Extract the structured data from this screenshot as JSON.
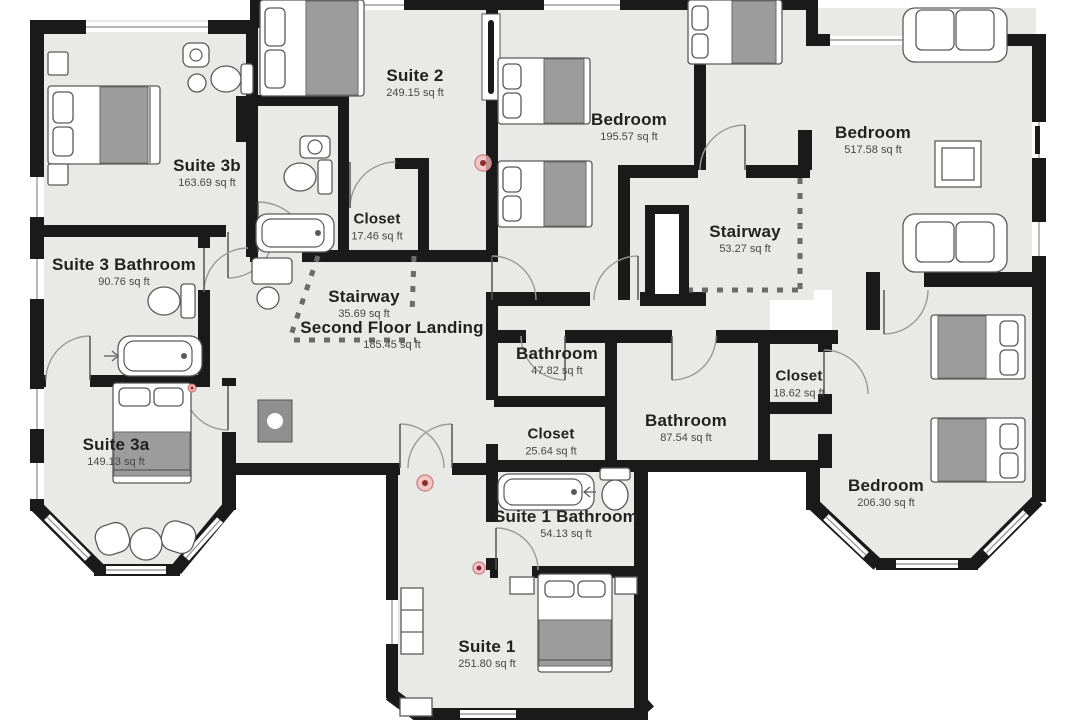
{
  "rooms": [
    {
      "id": "suite-3b",
      "name": "Suite 3b",
      "area": "163.69 sq ft"
    },
    {
      "id": "suite-2",
      "name": "Suite 2",
      "area": "249.15 sq ft"
    },
    {
      "id": "closet-a",
      "name": "Closet",
      "area": "17.46 sq ft"
    },
    {
      "id": "suite-3-bathroom",
      "name": "Suite 3 Bathroom",
      "area": "90.76 sq ft"
    },
    {
      "id": "stairway-a",
      "name": "Stairway",
      "area": "35.69 sq ft"
    },
    {
      "id": "second-floor-landing",
      "name": "Second Floor Landing",
      "area": "185.45 sq ft"
    },
    {
      "id": "bedroom-a",
      "name": "Bedroom",
      "area": "195.57 sq ft"
    },
    {
      "id": "stairway-b",
      "name": "Stairway",
      "area": "53.27 sq ft"
    },
    {
      "id": "bedroom-b",
      "name": "Bedroom",
      "area": "517.58 sq ft"
    },
    {
      "id": "bathroom-a",
      "name": "Bathroom",
      "area": "47.82 sq ft"
    },
    {
      "id": "closet-b",
      "name": "Closet",
      "area": "18.62 sq ft"
    },
    {
      "id": "bathroom-b",
      "name": "Bathroom",
      "area": "87.54 sq ft"
    },
    {
      "id": "closet-c",
      "name": "Closet",
      "area": "25.64 sq ft"
    },
    {
      "id": "suite-3a",
      "name": "Suite 3a",
      "area": "149.13 sq ft"
    },
    {
      "id": "bedroom-c",
      "name": "Bedroom",
      "area": "206.30 sq ft"
    },
    {
      "id": "suite-1-bathroom",
      "name": "Suite 1 Bathroom",
      "area": "54.13 sq ft"
    },
    {
      "id": "suite-1",
      "name": "Suite 1",
      "area": "251.80 sq ft"
    }
  ],
  "colors": {
    "wall": "#1a1a1a",
    "floor": "#e9e9e7",
    "blanket": "#9c9c9c",
    "sensor": "#8e2b2b",
    "background": "#ffffff"
  }
}
